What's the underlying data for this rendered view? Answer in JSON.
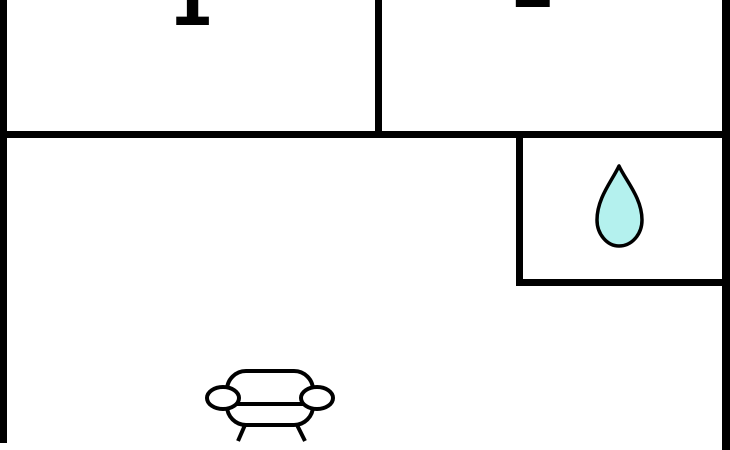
{
  "floorplan": {
    "room_labels": {
      "room1": "1",
      "room2": "2"
    },
    "icons": [
      {
        "name": "water-drop-icon",
        "location": "bathroom"
      },
      {
        "name": "sofa-icon",
        "location": "living-room"
      }
    ],
    "colors": {
      "background": "#ffffff",
      "wall": "#000000",
      "outline": "#000000",
      "drop_fill": "#b4f1ee"
    }
  }
}
